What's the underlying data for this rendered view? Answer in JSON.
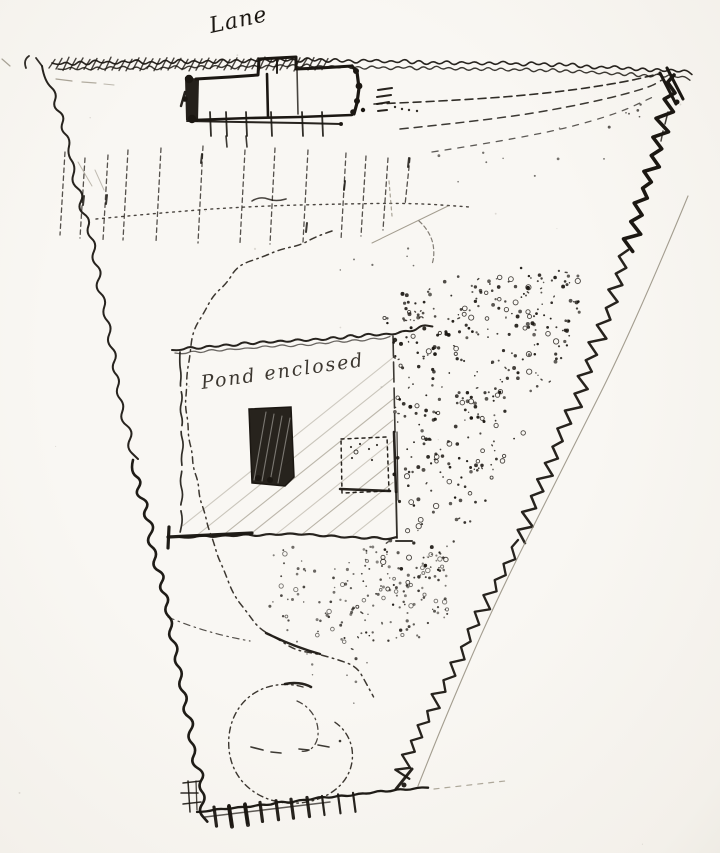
{
  "figure": {
    "type": "hand-drawn pen-and-ink plan sketch of a tapering plot of land beside a lane",
    "labels": {
      "lane": "Lane",
      "enclosure_note": "Pond enclosed"
    },
    "colors": {
      "paper": "#f7f5f0",
      "ink": "#1b1712",
      "soft_ink": "#2b2620",
      "faint": "#948d7e",
      "hatch": "#9a9383"
    },
    "regions": [
      "lane boundary hatching",
      "building block on lane",
      "fence line with posts",
      "rows of plantings",
      "dashed drive to corner gate",
      "winding dotted path",
      "hatched enclosure with note",
      "dark hatched block",
      "dotted outline block",
      "stippled ground",
      "spiral walk",
      "bottom gate with hatching"
    ]
  }
}
